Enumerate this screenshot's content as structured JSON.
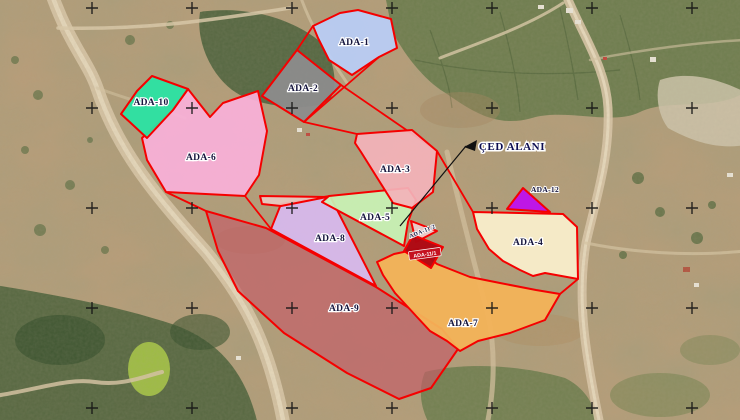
{
  "map": {
    "annotation": {
      "text": "ÇED ALANI",
      "x": 512,
      "y": 150,
      "arrow_points": "464,147 477,140 475,151",
      "leader": {
        "x1": 400,
        "y1": 226,
        "x2": 466,
        "y2": 146
      }
    },
    "colors": {
      "boundary_red": "#f50000",
      "cross_black": "#151515",
      "label_ink": "#16163e",
      "label_halo": "#ffffff",
      "annotation_ink": "#0d0d52"
    },
    "graticule": {
      "origin_x": 92,
      "origin_y": 8,
      "spacing": 100,
      "cols": 7,
      "rows": 5,
      "arm": 6
    },
    "connectors": [
      {
        "x1": 341,
        "y1": 85,
        "x2": 437,
        "y2": 151
      },
      {
        "x1": 379,
        "y1": 57,
        "x2": 304,
        "y2": 122
      },
      {
        "x1": 304,
        "y1": 122,
        "x2": 357,
        "y2": 134
      },
      {
        "x1": 437,
        "y1": 151,
        "x2": 473,
        "y2": 212
      },
      {
        "x1": 578,
        "y1": 279,
        "x2": 560,
        "y2": 294
      },
      {
        "x1": 166,
        "y1": 192,
        "x2": 206,
        "y2": 211
      },
      {
        "x1": 245,
        "y1": 196,
        "x2": 271,
        "y2": 229
      },
      {
        "x1": 313,
        "y1": 26,
        "x2": 297,
        "y2": 50
      }
    ],
    "parcels": [
      {
        "id": "ada-9",
        "label": "ADA-9",
        "fill": "#c45f68",
        "fill_opacity": 0.68,
        "points": "206,211 266,228 376,287 442,329 458,349 431,388 399,399 347,373 284,333 238,291 218,251",
        "label_x": 344,
        "label_y": 311
      },
      {
        "id": "ada-8",
        "label": "ADA-8",
        "fill": "#d7b9ee",
        "fill_opacity": 0.93,
        "points": "281,204 330,196 376,286 271,229",
        "label_x": 330,
        "label_y": 241
      },
      {
        "id": "sliver",
        "label": "",
        "fill": "#e9cbc2",
        "fill_opacity": 0.9,
        "points": "260,196 327,197 281,206 262,204",
        "label_x": 0,
        "label_y": 0
      },
      {
        "id": "ada-5",
        "label": "ADA-5",
        "fill": "#c8f2b5",
        "fill_opacity": 0.93,
        "points": "329,196 408,188 416,200 408,222 404,246 322,202",
        "label_x": 375,
        "label_y": 220
      },
      {
        "id": "ada-3",
        "label": "ADA-3",
        "fill": "#f3b3b9",
        "fill_opacity": 0.93,
        "points": "357,134 412,130 437,151 433,192 412,208 393,203 361,152 355,143",
        "label_x": 395,
        "label_y": 172
      },
      {
        "id": "ada-6",
        "label": "ADA-6",
        "fill": "#f9b0d8",
        "fill_opacity": 0.93,
        "points": "188,89 210,117 223,103 258,91 267,131 259,175 245,196 166,192 147,160 142,138 172,111",
        "label_x": 201,
        "label_y": 160
      },
      {
        "id": "ada-10",
        "label": "ADA-10",
        "fill": "#2be3a3",
        "fill_opacity": 0.95,
        "points": "152,76 188,89 173,110 147,138 121,114 137,91",
        "label_x": 151,
        "label_y": 105
      },
      {
        "id": "ada-2",
        "label": "ADA-2",
        "fill": "#8c8c8c",
        "fill_opacity": 0.95,
        "points": "297,50 341,85 304,122 262,96",
        "label_x": 303,
        "label_y": 91
      },
      {
        "id": "ada-1",
        "label": "ADA-1",
        "fill": "#b9cdf5",
        "fill_opacity": 0.94,
        "points": "313,26 340,13 358,10 391,19 397,48 379,57 352,75 329,60 318,38",
        "label_x": 354,
        "label_y": 45
      },
      {
        "id": "ada-4",
        "label": "ADA-4",
        "fill": "#f9eecb",
        "fill_opacity": 0.95,
        "points": "473,212 563,214 577,227 578,279 545,273 533,276 520,270 503,261 489,249 477,229",
        "label_x": 528,
        "label_y": 245
      },
      {
        "id": "ada-7",
        "label": "ADA-7",
        "fill": "#f3b358",
        "fill_opacity": 0.95,
        "points": "377,262 394,254 418,249 437,264 470,277 500,283 536,290 560,294 545,320 510,333 478,341 460,351 447,341 430,331 417,317 395,293 383,275",
        "label_x": 463,
        "label_y": 326
      },
      {
        "id": "ada-12",
        "label": "ADA-12",
        "fill": "#bf10ec",
        "fill_opacity": 0.95,
        "points": "507,209 523,188 550,212",
        "label_x": 545,
        "label_y": 192,
        "label_class": "lbl-mid"
      },
      {
        "id": "ada-11-2",
        "label": "ADA-11/2",
        "fill": "#eccaca",
        "fill_opacity": 0.95,
        "points": "411,221 437,231 416,242",
        "label_x": 423,
        "label_y": 233,
        "label_class": "lbl-sm",
        "rotate": -22
      },
      {
        "id": "ada-11-1",
        "label": "ADA-11/1",
        "fill": "#ae0712",
        "fill_opacity": 0.97,
        "points": "413,235 443,247 431,268 404,251",
        "label_x": 425,
        "label_y": 255,
        "boxed": true,
        "rotate": -8
      }
    ]
  }
}
